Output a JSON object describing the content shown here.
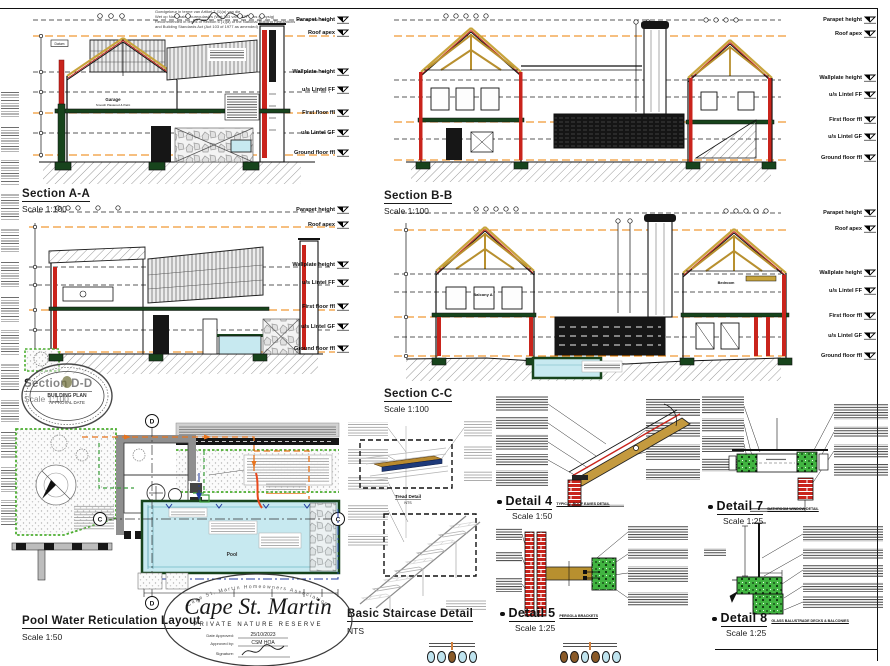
{
  "palette": {
    "orange": "#ee7f00",
    "red": "#c9241c",
    "dark_green": "#17441c",
    "timber": "#b8902f",
    "gold": "#c8a43c",
    "pool_cyan": "#c7e9f0",
    "concrete_green": "#41b441",
    "brick_red": "#c9241c"
  },
  "approval_notes": {
    "lines": [
      "Goedgekeur in terme van Artikel 7 (1)(a) van die",
      "Wet op Nasionale Bouregulasies (Wet 103 van 1977 soos gewysig)",
      "Recommended in terms of Section 6 (1)(a) of the National Building Regulations",
      "and Building Standards Act (Act 103 of 1977 as amended)"
    ]
  },
  "levels": {
    "labels": [
      "Parapet height",
      "Roof apex",
      "Wallplate height",
      "u/s Lintel FF",
      "First floor ffl",
      "u/s Lintel GF",
      "Ground floor ffl"
    ]
  },
  "sections": {
    "a": {
      "title": "Section A-A",
      "scale": "Scale 1:100",
      "room_label": "Garage",
      "room_sub": "Smooth Plastered & Paint",
      "datum": "Datum"
    },
    "b": {
      "title": "Section B-B",
      "scale": "Scale 1:100"
    },
    "c": {
      "title": "Section C-C",
      "scale": "Scale 1:100",
      "balcony": "Balcony A",
      "bedroom": "Bedroom"
    },
    "d": {
      "title": "Section D-D",
      "scale": "Scale 1:100"
    }
  },
  "pool_layout": {
    "title": "Pool Water Reticulation Layout",
    "scale": "Scale 1:50",
    "pool_label": "Pool",
    "grid_c": "C",
    "grid_d": "D"
  },
  "staircase": {
    "title": "Basic Staircase Detail",
    "scale": "NTS",
    "tread_title": "Tread Detail",
    "tread_scale": "NTS"
  },
  "details": {
    "d4": {
      "title": "Detail 4",
      "scale": "Scale 1:50",
      "tag": "TYPICAL ROOF EAVES DETAIL"
    },
    "d5": {
      "title": "Detail 5",
      "scale": "Scale 1:25",
      "tag": "PERGOLA BRACKETS"
    },
    "d7": {
      "title": "Detail 7",
      "scale": "Scale 1:25",
      "tag": "BATHROOM WINDOW DETAIL"
    },
    "d8": {
      "title": "Detail 8",
      "scale": "Scale 1:25",
      "tag": "GLASS BALUSTRADE DECKS & BALCONIES"
    }
  },
  "stamps": {
    "municipal": {
      "line1": "BUILDING PLAN",
      "line2": "APPROVAL DATE"
    },
    "cape": {
      "arc": "Cape St. Martin Homeowners Association",
      "name": "Cape St. Martin",
      "subtitle": "PRIVATE NATURE RESERVE",
      "date_label": "Date Approved:",
      "date_value": "25/10/2023",
      "approved_label": "Approved by:",
      "approved_value": "CSM HOA",
      "signature_label": "Signature:"
    }
  },
  "legend": {
    "left_colors": [
      "#bfe4ef",
      "#bfe4ef",
      "#8a5a28",
      "#bfe4ef",
      "#bfe4ef"
    ],
    "right_colors": [
      "#8a5a28",
      "#8a5a28",
      "#bfe4ef",
      "#8a5a28",
      "#bfe4ef",
      "#bfe4ef"
    ]
  }
}
